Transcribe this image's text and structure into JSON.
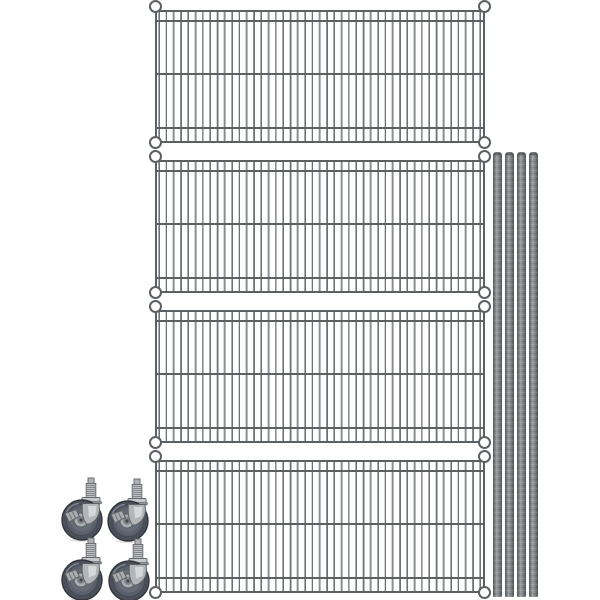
{
  "image": {
    "description": "Product photo of a gray wire shelving unit kit shown disassembled: four rectangular chrome-gray wire shelves stacked vertically, four metal shelving posts standing on the right, and four stem-mount swivel casters arranged two by two at the lower left on a white background.",
    "background_color": "#ffffff"
  },
  "parts": {
    "shelves": {
      "label": "wire-shelf",
      "count": 4,
      "colors": {
        "frame": "#5d6063",
        "wire_light": "#a9acaf",
        "wire_dark": "#6f7275"
      }
    },
    "posts": {
      "label": "shelving-post",
      "count": 4,
      "colors": {
        "body": "#8b8e91",
        "edge": "#54575a"
      }
    },
    "casters": {
      "label": "swivel-caster",
      "count": 4,
      "colors": {
        "tire": "#4a4f59",
        "wheel_inner": "#5b616c",
        "hub": "#a9aeb3",
        "bracket": "#b3b6b9",
        "stem": "#bec1c4"
      }
    }
  }
}
